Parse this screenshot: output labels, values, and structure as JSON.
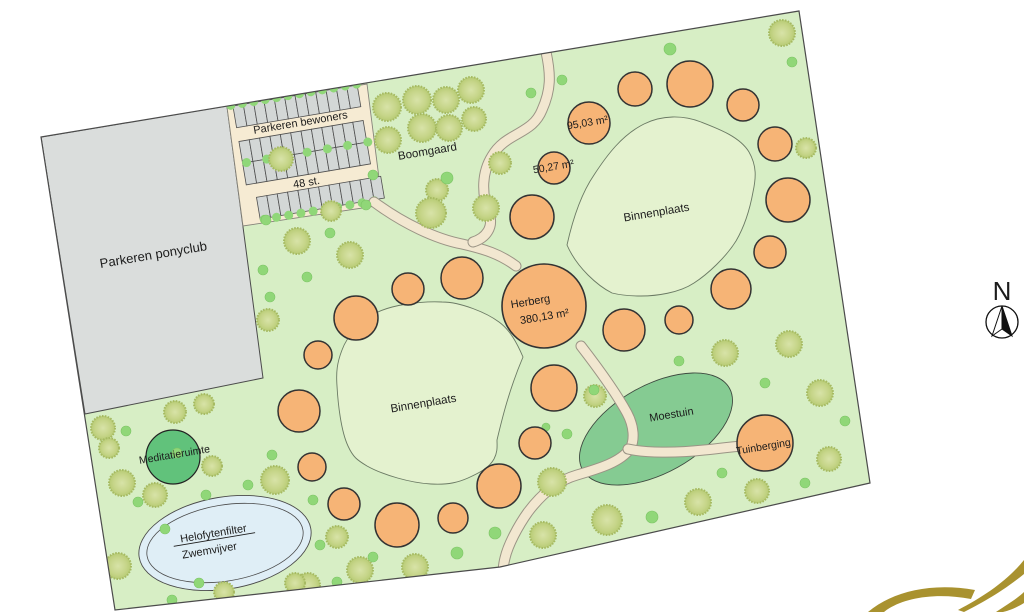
{
  "title": "Landschapsplan site plan",
  "colors": {
    "grass": "#d7eec5",
    "courtyard": "#e4f2cf",
    "courtyard_stroke": "#6b7a64",
    "orange": "#f6b476",
    "orange_stroke": "#333333",
    "tree_fill": "#c6d589",
    "tree_edge": "#a6ba62",
    "shrub": "#90d778",
    "moestuin": "#85cb92",
    "moestuin_stroke": "#3e4a40",
    "meditation": "#61c27b",
    "pond": "#dfeef6",
    "pond_stroke": "#4a4a4a",
    "path_fill": "#f2e7d0",
    "path_edge": "#9a9485",
    "parking_cream": "#f6ebd3",
    "parking_edge": "#85837a",
    "stall_gray": "#d3d7d6",
    "stall_stroke": "#4f4f4f",
    "ponyclub_gray": "#dadddc",
    "boundary": "#4b4b4b",
    "gold": "#a9922f",
    "text": "#1c1c1c"
  },
  "rotation_deg": -9.5,
  "site": {
    "outline": "41,137 799,11 870,483 500,567 115,610"
  },
  "zones": {
    "parking_ponyclub": {
      "points": "41,137 227,106 263,378 85,414"
    },
    "parking_bewoners": {
      "points": "227,107 367,84 381,194 376,206 243,226",
      "origin": [
        227,
        107
      ],
      "angle": -9.6,
      "stall_w": 10.5,
      "stall_h": 22,
      "rows": [
        {
          "x": 6,
          "y": 0,
          "n": 12
        },
        {
          "x": 6,
          "y": 36,
          "n": 12
        },
        {
          "x": 6,
          "y": 58,
          "n": 12
        },
        {
          "x": 14,
          "y": 94,
          "n": 12
        }
      ],
      "dot_rows": [
        {
          "y": -1,
          "x0": 4,
          "dx": 11.6,
          "n": 12
        },
        {
          "y": 58,
          "x0": 10,
          "dx": 20.5,
          "n": 7
        },
        {
          "y": 117,
          "x0": 18,
          "dx": 12.4,
          "n": 10
        }
      ]
    },
    "courtyard_upper": {
      "d": "M567,245 C573,218 581,194 594,175 C607,155 622,135 644,124 C662,115 683,115 701,122 C719,129 740,137 749,152 C757,166 756,178 753,192 C749,214 743,229 736,241 C726,257 708,274 694,283 C679,293 656,296 641,296 C631,296 620,295 612,293 C598,286 577,268 567,245 Z"
    },
    "courtyard_lower": {
      "d": "M523,357 C517,343 510,330 499,322 C487,313 461,302 442,302 C420,301 391,305 376,313 C361,321 347,336 342,350 C337,363 336,372 337,386 C338,404 341,431 348,446 C353,457 357,460 367,466 C383,475 411,483 431,484 C449,485 459,482 468,478 C479,473 489,468 494,459 C498,451 497,446 497,440 C502,419 509,390 523,357 Z"
    },
    "moestuin": {
      "cx": 656,
      "cy": 429,
      "rx": 84,
      "ry": 44,
      "rot": -29
    },
    "pond": {
      "cx": 225,
      "cy": 543,
      "rx": 87,
      "ry": 46,
      "rx2": 79,
      "ry2": 38,
      "rot": -9.5
    },
    "meditation": {
      "cx": 173,
      "cy": 457,
      "r": 27
    }
  },
  "herberg": {
    "cx": 544,
    "cy": 306,
    "r": 42
  },
  "tuinberging": {
    "cx": 765,
    "cy": 443,
    "r": 28
  },
  "pitches": {
    "upper_ring": [
      [
        532,
        217,
        22
      ],
      [
        554,
        168,
        16
      ],
      [
        589,
        123,
        21
      ],
      [
        635,
        89,
        17
      ],
      [
        690,
        84,
        23
      ],
      [
        743,
        105,
        16
      ],
      [
        775,
        144,
        17
      ],
      [
        788,
        200,
        22
      ],
      [
        770,
        252,
        16
      ],
      [
        731,
        289,
        20
      ],
      [
        679,
        320,
        14
      ],
      [
        624,
        330,
        21
      ]
    ],
    "lower_ring": [
      [
        462,
        278,
        21
      ],
      [
        408,
        289,
        16
      ],
      [
        356,
        318,
        22
      ],
      [
        318,
        355,
        14
      ],
      [
        299,
        411,
        21
      ],
      [
        312,
        467,
        14
      ],
      [
        344,
        504,
        16
      ],
      [
        397,
        525,
        22
      ],
      [
        453,
        518,
        15
      ],
      [
        499,
        486,
        22
      ],
      [
        535,
        443,
        16
      ],
      [
        554,
        388,
        23
      ]
    ]
  },
  "paths": [
    {
      "name": "footpath-parking-to-courtyard",
      "d": "M374,202 C404,224 436,239 462,244 C484,249 500,254 516,266"
    },
    {
      "name": "footpath-north-entrance",
      "d": "M546,52 C551,75 551,90 542,110 C532,135 506,132 492,156 C482,172 481,193 489,214 C494,227 486,238 473,242"
    },
    {
      "name": "footpath-south",
      "d": "M581,346 C598,368 615,391 627,413 C634,426 635,440 630,449 C620,462 601,468 577,475 C556,481 540,496 528,512 C518,526 508,545 505,558 C503,566 503,570 504,575"
    },
    {
      "name": "footpath-to-tuinberging",
      "d": "M628,449 C646,453 676,453 704,450 C716,449 728,447 742,446"
    }
  ],
  "trees": {
    "large": [
      [
        387,
        107,
        14
      ],
      [
        417,
        100,
        14
      ],
      [
        446,
        100,
        13
      ],
      [
        471,
        90,
        13
      ],
      [
        422,
        128,
        14
      ],
      [
        449,
        128,
        13
      ],
      [
        474,
        119,
        12
      ],
      [
        388,
        140,
        13
      ],
      [
        437,
        190,
        11
      ],
      [
        500,
        163,
        11
      ],
      [
        281,
        159,
        12
      ],
      [
        331,
        211,
        10
      ],
      [
        297,
        241,
        13
      ],
      [
        350,
        255,
        13
      ],
      [
        431,
        213,
        15
      ],
      [
        486,
        208,
        13
      ],
      [
        268,
        320,
        11
      ],
      [
        782,
        33,
        13
      ],
      [
        806,
        148,
        10
      ],
      [
        725,
        353,
        13
      ],
      [
        789,
        344,
        13
      ],
      [
        820,
        393,
        13
      ],
      [
        829,
        459,
        12
      ],
      [
        595,
        396,
        11
      ],
      [
        552,
        482,
        14
      ],
      [
        607,
        520,
        15
      ],
      [
        543,
        535,
        13
      ],
      [
        698,
        502,
        13
      ],
      [
        757,
        491,
        12
      ],
      [
        275,
        480,
        14
      ],
      [
        337,
        537,
        11
      ],
      [
        360,
        570,
        13
      ],
      [
        415,
        567,
        13
      ],
      [
        308,
        585,
        12
      ],
      [
        122,
        483,
        13
      ],
      [
        155,
        495,
        12
      ],
      [
        118,
        566,
        13
      ],
      [
        103,
        428,
        12
      ],
      [
        109,
        448,
        10
      ],
      [
        175,
        412,
        11
      ],
      [
        204,
        404,
        10
      ],
      [
        212,
        466,
        10
      ],
      [
        224,
        592,
        10
      ],
      [
        295,
        583,
        10
      ]
    ],
    "small": [
      [
        670,
        49,
        6
      ],
      [
        792,
        62,
        5
      ],
      [
        562,
        80,
        5
      ],
      [
        531,
        93,
        5
      ],
      [
        373,
        175,
        5
      ],
      [
        447,
        178,
        6
      ],
      [
        266,
        220,
        5
      ],
      [
        366,
        205,
        5
      ],
      [
        263,
        270,
        5
      ],
      [
        307,
        277,
        5
      ],
      [
        330,
        233,
        5
      ],
      [
        270,
        297,
        5
      ],
      [
        126,
        431,
        5
      ],
      [
        177,
        453,
        5
      ],
      [
        165,
        529,
        5
      ],
      [
        138,
        502,
        5
      ],
      [
        206,
        495,
        5
      ],
      [
        248,
        485,
        5
      ],
      [
        320,
        545,
        5
      ],
      [
        199,
        583,
        5
      ],
      [
        172,
        600,
        5
      ],
      [
        272,
        455,
        5
      ],
      [
        313,
        500,
        5
      ],
      [
        373,
        557,
        5
      ],
      [
        457,
        553,
        6
      ],
      [
        495,
        533,
        6
      ],
      [
        337,
        582,
        5
      ],
      [
        679,
        361,
        5
      ],
      [
        765,
        383,
        5
      ],
      [
        845,
        421,
        5
      ],
      [
        567,
        434,
        5
      ],
      [
        722,
        473,
        5
      ],
      [
        805,
        483,
        5
      ],
      [
        652,
        517,
        6
      ],
      [
        594,
        390,
        5
      ],
      [
        546,
        427,
        4
      ]
    ]
  },
  "labels": [
    {
      "name": "parkeren-ponyclub",
      "text": "Parkeren ponyclub",
      "x": 154,
      "y": 259,
      "size": 13
    },
    {
      "name": "parkeren-bewoners",
      "text": "Parkeren bewoners",
      "x": 301,
      "y": 126,
      "size": 11
    },
    {
      "name": "parkeren-count",
      "text": "48 st.",
      "x": 307,
      "y": 186,
      "size": 11
    },
    {
      "name": "boomgaard",
      "text": "Boomgaard",
      "x": 428,
      "y": 155,
      "size": 11.5
    },
    {
      "name": "pitch-area-95",
      "text": "95,03 m²",
      "x": 588,
      "y": 126,
      "size": 10.5
    },
    {
      "name": "pitch-area-50",
      "text": "50,27 m²",
      "x": 554,
      "y": 170,
      "size": 10.5
    },
    {
      "name": "binnenplaats-upper",
      "text": "Binnenplaats",
      "x": 657,
      "y": 216,
      "size": 11.5
    },
    {
      "name": "herberg",
      "text": "Herberg",
      "x": 531,
      "y": 305,
      "size": 11
    },
    {
      "name": "herberg-area",
      "text": "380,13 m²",
      "x": 545,
      "y": 320,
      "size": 11
    },
    {
      "name": "binnenplaats-lower",
      "text": "Binnenplaats",
      "x": 424,
      "y": 407,
      "size": 11.5
    },
    {
      "name": "moestuin",
      "text": "Moestuin",
      "x": 672,
      "y": 418,
      "size": 11
    },
    {
      "name": "tuinberging",
      "text": "Tuinberging",
      "x": 764,
      "y": 450,
      "size": 10.5
    },
    {
      "name": "meditatieruimte",
      "text": "Meditatieruimte",
      "x": 175,
      "y": 458,
      "size": 10.5
    },
    {
      "name": "helofytenfilter",
      "text": "Helofytenfilter",
      "x": 214,
      "y": 537,
      "size": 11,
      "underline": true
    },
    {
      "name": "zwemvijver",
      "text": "Zwemvijver",
      "x": 210,
      "y": 554,
      "size": 11
    }
  ],
  "compass": {
    "label": "N",
    "cx": 1002,
    "cy": 322,
    "r": 16,
    "label_x": 1002,
    "label_y": 300,
    "label_size": 26
  },
  "logo_fragment": {
    "paths": [
      "M868,612 C892,592 930,582 975,590 L971,599 C935,592 901,598 884,612 Z",
      "M958,610 C985,596 1008,580 1024,560 L1024,574 C1002,592 980,604 964,612 Z",
      "M996,612 C1008,604 1018,598 1024,592 L1024,603 C1016,608 1008,611 1003,612 Z"
    ]
  }
}
